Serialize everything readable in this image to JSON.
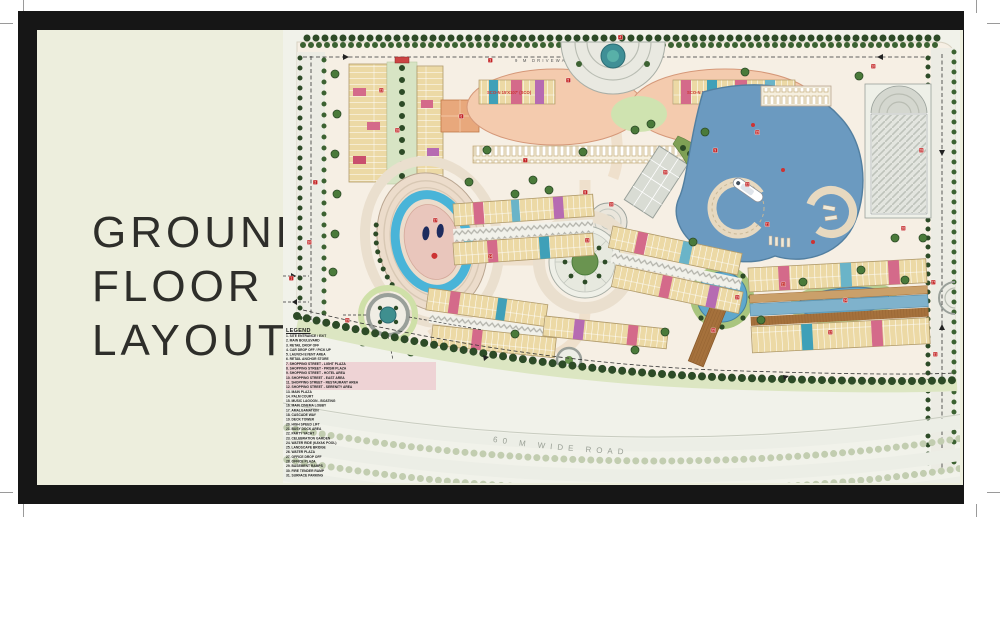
{
  "page": {
    "title_lines": [
      "GROUND",
      "FLOOR",
      "LAYOUT"
    ]
  },
  "plan": {
    "labels": {
      "top_driveway": "9 M DRIVEWAY",
      "bottom_road": "60 M WIDE ROAD",
      "sco_band_left": "SCO-N 15'X107' (SCO)",
      "sco_band_right": "SCO-N 15'X107' (SCO)"
    },
    "legend": {
      "title": "LEGEND",
      "items": [
        "1.  SITE ENTRANCE / EXIT",
        "2.  MAIN BOULEVARD",
        "3.  RETAIL DROP OFF",
        "4.  CAR DROP OFF / PICK UP",
        "5.  LAUNCH EVENT AREA",
        "6.  RETAIL ANCHOR STORE",
        "7.  SHOPPING STREET - LIGHT PLAZA",
        "8.  SHOPPING STREET - PRISM PLAZA",
        "9.  SHOPPING STREET - HOTEL AREA",
        "10. SHOPPING STREET - EAST AREA",
        "11. SHOPPING STREET - RESTAURANT AREA",
        "12. SHOPPING STREET - SERENITY AREA",
        "13. MAIN PLAZA",
        "14. PALM COURT",
        "15. MUSIC LAGOON - BOATING",
        "16. MAIN CINEMA LOBBY",
        "17. AMALGAMATION",
        "18. CASCADE WAY",
        "19. DECK TOWER",
        "20. HIGH SPEED LIFT",
        "21. BUSY DOCK AREA",
        "22. PARTY YACHT",
        "23. CELEBRATION GARDEN",
        "24. WATER RIDE (KAYAK POOL)",
        "25. LANDSCAPE BRIDGE",
        "26. WATER PLAZA",
        "27. OFFICE DROP OFF",
        "28. OFFICE PLAZA",
        "29. BASEMENT RAMPS",
        "30. FIRE TENDER RAMP",
        "31. SURFACE PARKING"
      ]
    },
    "markers": [
      {
        "n": 1,
        "x": 6,
        "y": 246
      },
      {
        "n": 2,
        "x": 30,
        "y": 150
      },
      {
        "n": 3,
        "x": 205,
        "y": 28
      },
      {
        "n": 4,
        "x": 335,
        "y": 5
      },
      {
        "n": 5,
        "x": 283,
        "y": 48
      },
      {
        "n": 6,
        "x": 176,
        "y": 84
      },
      {
        "n": 7,
        "x": 240,
        "y": 128
      },
      {
        "n": 8,
        "x": 300,
        "y": 160
      },
      {
        "n": 9,
        "x": 430,
        "y": 118
      },
      {
        "n": 10,
        "x": 588,
        "y": 34
      },
      {
        "n": 11,
        "x": 498,
        "y": 252
      },
      {
        "n": 12,
        "x": 545,
        "y": 300
      },
      {
        "n": 13,
        "x": 302,
        "y": 208
      },
      {
        "n": 14,
        "x": 205,
        "y": 224
      },
      {
        "n": 15,
        "x": 472,
        "y": 100
      },
      {
        "n": 16,
        "x": 326,
        "y": 172
      },
      {
        "n": 17,
        "x": 150,
        "y": 188
      },
      {
        "n": 18,
        "x": 112,
        "y": 98
      },
      {
        "n": 19,
        "x": 452,
        "y": 265
      },
      {
        "n": 20,
        "x": 380,
        "y": 140
      },
      {
        "n": 21,
        "x": 482,
        "y": 192
      },
      {
        "n": 22,
        "x": 462,
        "y": 152
      },
      {
        "n": 23,
        "x": 96,
        "y": 58
      },
      {
        "n": 24,
        "x": 560,
        "y": 268
      },
      {
        "n": 25,
        "x": 428,
        "y": 298
      },
      {
        "n": 26,
        "x": 618,
        "y": 196
      },
      {
        "n": 27,
        "x": 648,
        "y": 250
      },
      {
        "n": 28,
        "x": 636,
        "y": 118
      },
      {
        "n": 29,
        "x": 62,
        "y": 288
      },
      {
        "n": 30,
        "x": 24,
        "y": 210
      },
      {
        "n": 31,
        "x": 650,
        "y": 322
      }
    ],
    "colors": {
      "frame": "#161616",
      "background_cream": "#edeedd",
      "water": "#6b9ac0",
      "shops_tan": "#ecd9a5",
      "sco_band": "#f4cbae",
      "tree_dark": "#2d4b27",
      "accent_pink": "#d46a8a",
      "accent_blue": "#6ab4c8",
      "marker_red": "#c22222"
    }
  }
}
